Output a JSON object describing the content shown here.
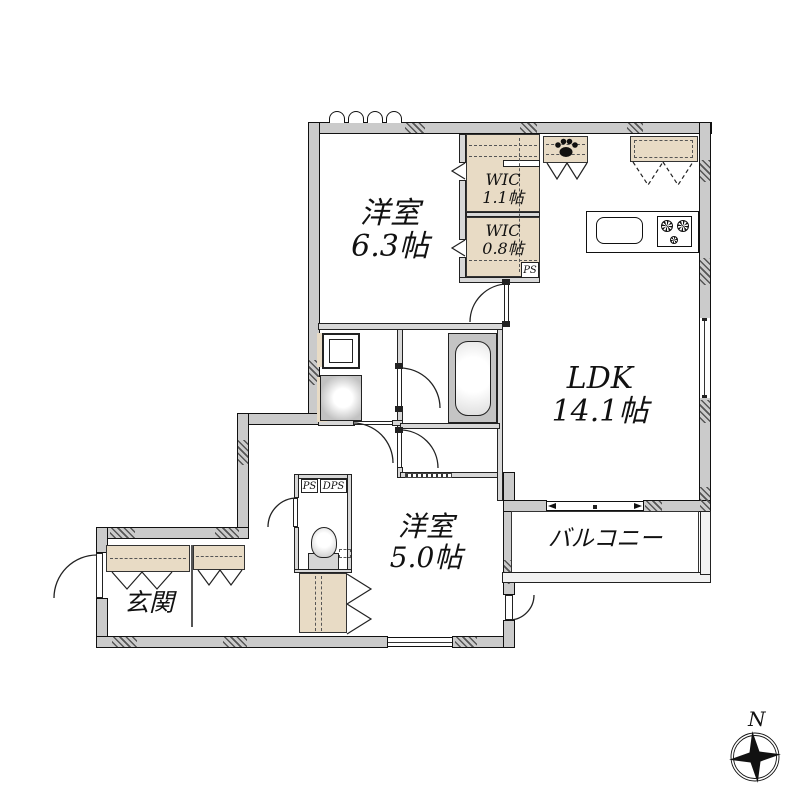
{
  "rooms": {
    "western_6_3": {
      "name": "洋室",
      "size": "6.3帖"
    },
    "wic_1_1": {
      "name": "WIC",
      "size": "1.1帖"
    },
    "wic_0_8": {
      "name": "WIC",
      "size": "0.8帖"
    },
    "ldk": {
      "name": "LDK",
      "size": "14.1帖"
    },
    "western_5_0": {
      "name": "洋室",
      "size": "5.0帖"
    },
    "balcony": {
      "name": "バルコニー"
    },
    "entrance": {
      "name": "玄関"
    }
  },
  "shafts": {
    "ps_upper": "PS",
    "ps_lower": "PS",
    "dps": "DPS"
  },
  "compass": {
    "north_label": "N"
  },
  "icons": {
    "paw": "paw-icon",
    "sink": "kitchen-sink-icon",
    "stove": "stove-burners-icon",
    "bathtub": "bathtub-icon",
    "toilet": "toilet-icon",
    "compass": "compass-rose-icon"
  },
  "colors": {
    "background": "#ffffff",
    "wall_fill": "#cbcbcb",
    "wall_edge": "#111111",
    "storage_fill": "#e8dbc5",
    "fixture_gray": "#c6c6c6",
    "line": "#222222"
  }
}
